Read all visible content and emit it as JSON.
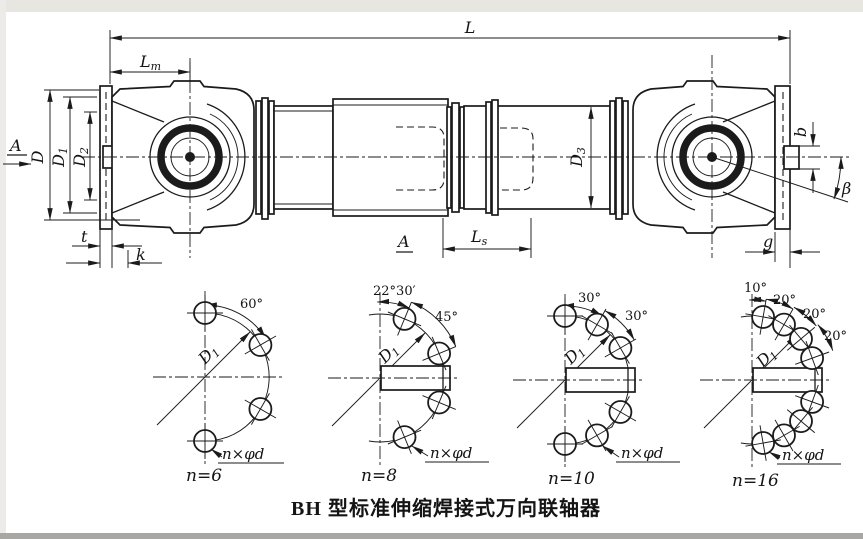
{
  "caption": "BH 型标准伸缩焊接式万向联轴器",
  "colors": {
    "ink": "#1b1b1b",
    "paper": "#ffffff",
    "scan_edge": "#e8e6e1"
  },
  "main_view": {
    "dim_L": "L",
    "dim_Lm": {
      "base": "L",
      "sub": "m"
    },
    "dim_Ls": {
      "base": "L",
      "sub": "s"
    },
    "dim_D": "D",
    "dim_D1": {
      "base": "D",
      "sub": "1"
    },
    "dim_D2": {
      "base": "D",
      "sub": "2"
    },
    "dim_D3": {
      "base": "D",
      "sub": "3"
    },
    "dim_t": "t",
    "dim_k": "k",
    "dim_b": "b",
    "dim_g": "g",
    "dim_beta": "β",
    "view_arrow_label": "A",
    "section_label": "A"
  },
  "bolt_diagrams": [
    {
      "count_label": "n=6",
      "angle_labels": [
        "60°"
      ],
      "holes_label": "n×φd",
      "bolt_circle_dia": {
        "base": "D",
        "sub": "1"
      },
      "hole_angles_deg": [
        90,
        30,
        -30,
        -90
      ],
      "keyway": false
    },
    {
      "count_label": "n=8",
      "angle_labels": [
        "22°30′",
        "45°"
      ],
      "holes_label": "n×φd",
      "bolt_circle_dia": {
        "base": "D",
        "sub": "1"
      },
      "hole_angles_deg": [
        67.5,
        22.5,
        -22.5,
        -67.5
      ],
      "keyway": true
    },
    {
      "count_label": "n=10",
      "angle_labels": [
        "30°",
        "30°"
      ],
      "holes_label": "n×φd",
      "bolt_circle_dia": {
        "base": "D",
        "sub": "1"
      },
      "hole_angles_deg": [
        90,
        60,
        30,
        -30,
        -60,
        -90
      ],
      "keyway": true
    },
    {
      "count_label": "n=16",
      "angle_labels": [
        "10°",
        "20°",
        "20°",
        "20°"
      ],
      "holes_label": "n×φd",
      "bolt_circle_dia": {
        "base": "D",
        "sub": "1"
      },
      "hole_angles_deg": [
        80,
        60,
        40,
        20,
        -20,
        -40,
        -60,
        -80
      ],
      "keyway": true
    }
  ]
}
